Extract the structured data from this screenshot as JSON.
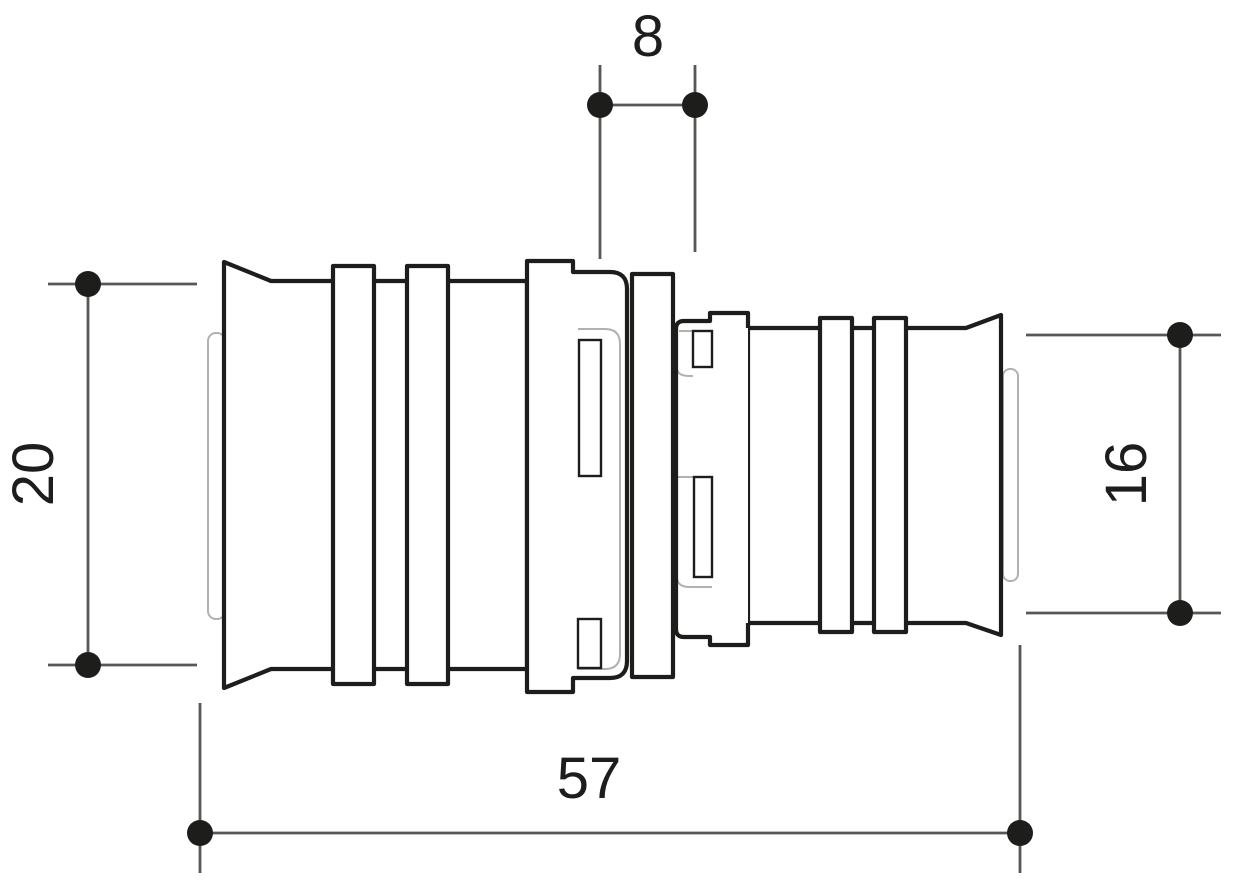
{
  "drawing": {
    "kind": "technical-dimension-drawing",
    "subject": "press-fit pipe reducer coupling, side view",
    "dimensions": {
      "top_width": "8",
      "left_diameter": "20",
      "right_diameter": "16",
      "overall_length": "57"
    },
    "colors": {
      "background": "#ffffff",
      "part_outline": "#1d1d1b",
      "dimension_lines": "#575756",
      "hidden_detail": "#b1b1b1",
      "text": "#1d1d1b"
    }
  }
}
